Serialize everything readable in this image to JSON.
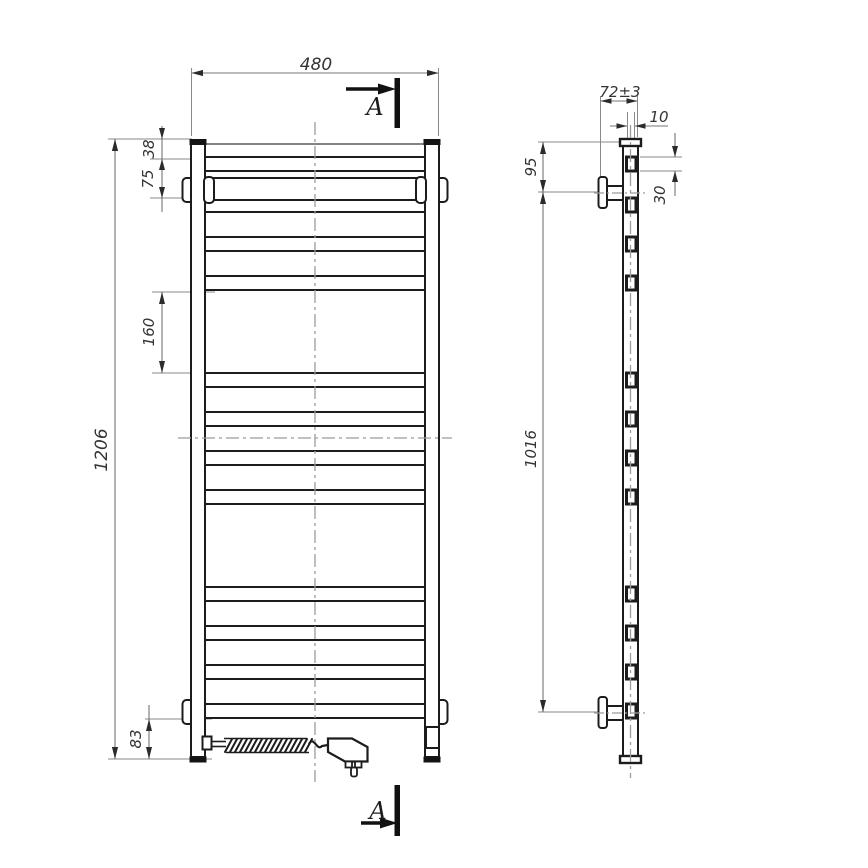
{
  "drawing": {
    "section_marks": {
      "top": "A",
      "bottom": "A"
    },
    "front_view_dims": {
      "width": "480",
      "height": "1206",
      "top_to_first_rung": "38",
      "rung_pitch": "75",
      "group_gap": "160",
      "bottom_offset": "83"
    },
    "side_view_dims": {
      "depth": "72±3",
      "rung_depth": "10",
      "top_to_bracket": "95",
      "rung_height": "30",
      "bracket_spacing": "1016"
    },
    "colors": {
      "object_line": "#1c1c1c",
      "dimension_line": "#757575",
      "centerline": "#9c9c9c",
      "text": "#333333",
      "arrow": "#2b2b2b"
    }
  }
}
